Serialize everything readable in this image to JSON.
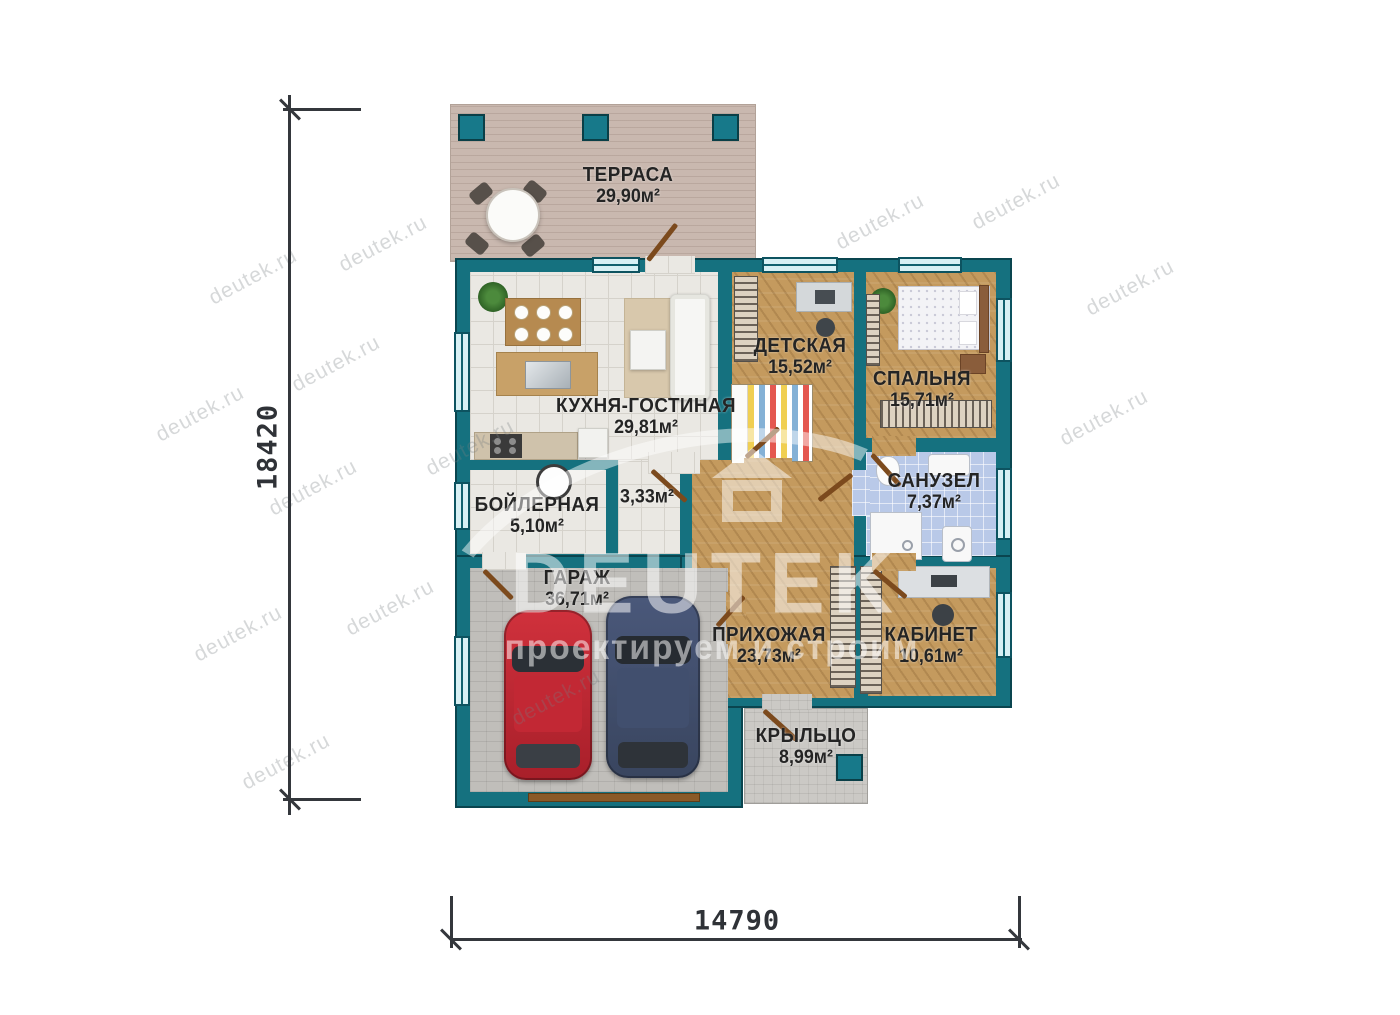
{
  "rooms": [
    {
      "name": "ТЕРРАСА",
      "area": "29,90м²"
    },
    {
      "name": "КУХНЯ-ГОСТИНАЯ",
      "area": "29,81м²"
    },
    {
      "name": "ДЕТСКАЯ",
      "area": "15,52м²"
    },
    {
      "name": "СПАЛЬНЯ",
      "area": "15,71м²"
    },
    {
      "name": "САНУЗЕЛ",
      "area": "7,37м²"
    },
    {
      "name": "БОЙЛЕРНАЯ",
      "area": "5,10м²"
    },
    {
      "name": "",
      "area": "3,33м²"
    },
    {
      "name": "ГАРАЖ",
      "area": "36,71м²"
    },
    {
      "name": "ПРИХОЖАЯ",
      "area": "23,73м²"
    },
    {
      "name": "КАБИНЕТ",
      "area": "10,61м²"
    },
    {
      "name": "КРЫЛЬЦО",
      "area": "8,99м²"
    }
  ],
  "dimensions": {
    "vertical": "18420",
    "horizontal": "14790"
  },
  "watermark": {
    "site": "deutek.ru",
    "brand": "DEUTEK",
    "slogan": "проектируем и строим"
  },
  "colors": {
    "wall": "#15717f",
    "wall_outline": "#0a454f",
    "window_glass": "#d8f0f4",
    "wood_floor": "#c49a5e",
    "terrace_deck": "#c9b8af",
    "bath_tile": "#b9c9e8",
    "garage_floor": "#c0beba",
    "dimension_line": "#34373c",
    "door_leaf": "#7c4a1d",
    "car_red": "#c02834",
    "car_blue": "#414f6e"
  }
}
